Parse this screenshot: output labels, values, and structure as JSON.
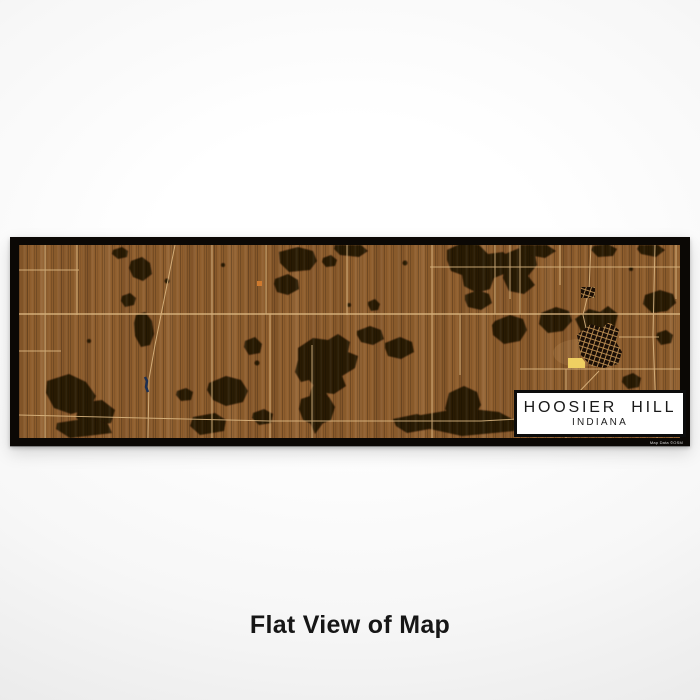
{
  "page": {
    "caption": "Flat View of Map"
  },
  "poster": {
    "label_box": {
      "title": "HOOSIER HILL",
      "subtitle": "INDIANA"
    },
    "attribution": "Map Data ©OSM",
    "style": {
      "frame": "#0b0805",
      "land": "#8f5e2d",
      "forest": "#221204",
      "road": "#e0bb85",
      "water": "#1c2f52",
      "town_marker": "#efcf62",
      "poi_marker": "#cf7a2e",
      "town_streets": "#bf9154"
    }
  }
}
